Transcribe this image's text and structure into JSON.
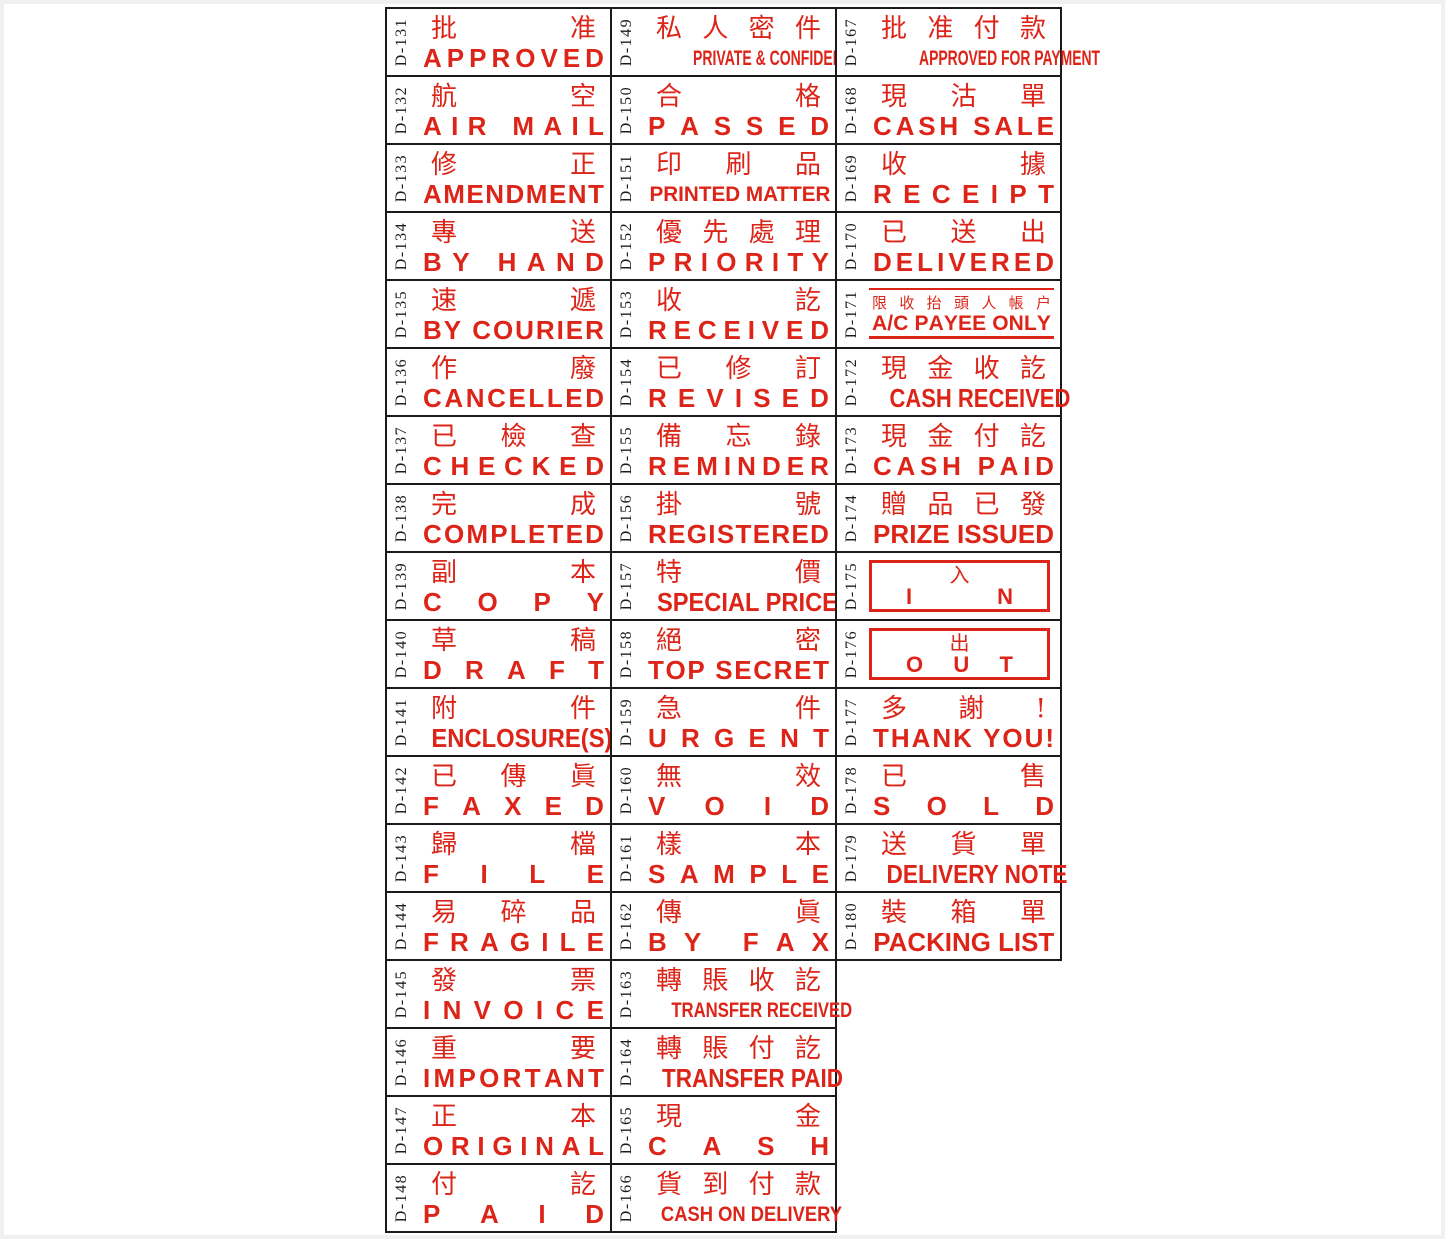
{
  "colors": {
    "stamp_red": "#dd2418",
    "grid_line": "#1a1a1a",
    "code_text": "#1c1c1c",
    "page_frame": "#f0f0f0",
    "paper": "#ffffff"
  },
  "catalog": {
    "columns": [
      {
        "stamps": [
          {
            "code": "D-131",
            "zh": "批准",
            "en": "APPROVED",
            "variant": "default"
          },
          {
            "code": "D-132",
            "zh": "航空",
            "en": "AIR MAIL",
            "variant": "default"
          },
          {
            "code": "D-133",
            "zh": "修正",
            "en": "AMENDMENT",
            "variant": "default"
          },
          {
            "code": "D-134",
            "zh": "專送",
            "en": "BY HAND",
            "variant": "default"
          },
          {
            "code": "D-135",
            "zh": "速遞",
            "en": "BY COURIER",
            "variant": "default"
          },
          {
            "code": "D-136",
            "zh": "作廢",
            "en": "CANCELLED",
            "variant": "default"
          },
          {
            "code": "D-137",
            "zh": "已檢查",
            "en": "CHECKED",
            "variant": "default"
          },
          {
            "code": "D-138",
            "zh": "完成",
            "en": "COMPLETED",
            "variant": "default"
          },
          {
            "code": "D-139",
            "zh": "副本",
            "en": "COPY",
            "variant": "default"
          },
          {
            "code": "D-140",
            "zh": "草稿",
            "en": "DRAFT",
            "variant": "default"
          },
          {
            "code": "D-141",
            "zh": "附件",
            "en": "ENCLOSURE(S)",
            "variant": "default"
          },
          {
            "code": "D-142",
            "zh": "已傳眞",
            "en": "FAXED",
            "variant": "default"
          },
          {
            "code": "D-143",
            "zh": "歸檔",
            "en": "FILE",
            "variant": "default"
          },
          {
            "code": "D-144",
            "zh": "易碎品",
            "en": "FRAGILE",
            "variant": "default"
          },
          {
            "code": "D-145",
            "zh": "發票",
            "en": "INVOICE",
            "variant": "default"
          },
          {
            "code": "D-146",
            "zh": "重要",
            "en": "IMPORTANT",
            "variant": "default"
          },
          {
            "code": "D-147",
            "zh": "正本",
            "en": "ORIGINAL",
            "variant": "default"
          },
          {
            "code": "D-148",
            "zh": "付訖",
            "en": "PAID",
            "variant": "default"
          }
        ]
      },
      {
        "stamps": [
          {
            "code": "D-149",
            "zh": "私人密件",
            "en": "PRIVATE & CONFIDENTIAL",
            "variant": "default"
          },
          {
            "code": "D-150",
            "zh": "合格",
            "en": "PASSED",
            "variant": "default"
          },
          {
            "code": "D-151",
            "zh": "印刷品",
            "en": "PRINTED MATTER",
            "variant": "default"
          },
          {
            "code": "D-152",
            "zh": "優先處理",
            "en": "PRIORITY",
            "variant": "default"
          },
          {
            "code": "D-153",
            "zh": "收訖",
            "en": "RECEIVED",
            "variant": "default"
          },
          {
            "code": "D-154",
            "zh": "已修訂",
            "en": "REVISED",
            "variant": "default"
          },
          {
            "code": "D-155",
            "zh": "備忘錄",
            "en": "REMINDER",
            "variant": "default"
          },
          {
            "code": "D-156",
            "zh": "掛號",
            "en": "REGISTERED",
            "variant": "default"
          },
          {
            "code": "D-157",
            "zh": "特價",
            "en": "SPECIAL PRICE",
            "variant": "default"
          },
          {
            "code": "D-158",
            "zh": "絕密",
            "en": "TOP SECRET",
            "variant": "default"
          },
          {
            "code": "D-159",
            "zh": "急件",
            "en": "URGENT",
            "variant": "default"
          },
          {
            "code": "D-160",
            "zh": "無效",
            "en": "VOID",
            "variant": "default"
          },
          {
            "code": "D-161",
            "zh": "樣本",
            "en": "SAMPLE",
            "variant": "default"
          },
          {
            "code": "D-162",
            "zh": "傳眞",
            "en": "BY FAX",
            "variant": "default"
          },
          {
            "code": "D-163",
            "zh": "轉賬收訖",
            "en": "TRANSFER RECEIVED",
            "variant": "default"
          },
          {
            "code": "D-164",
            "zh": "轉賬付訖",
            "en": "TRANSFER PAID",
            "variant": "default"
          },
          {
            "code": "D-165",
            "zh": "現金",
            "en": "CASH",
            "variant": "default"
          },
          {
            "code": "D-166",
            "zh": "貨到付款",
            "en": "CASH ON DELIVERY",
            "variant": "default"
          }
        ]
      },
      {
        "stamps": [
          {
            "code": "D-167",
            "zh": "批准付款",
            "en": "APPROVED FOR PAYMENT",
            "variant": "default"
          },
          {
            "code": "D-168",
            "zh": "現沽單",
            "en": "CASH SALE",
            "variant": "default"
          },
          {
            "code": "D-169",
            "zh": "收據",
            "en": "RECEIPT",
            "variant": "default"
          },
          {
            "code": "D-170",
            "zh": "已送出",
            "en": "DELIVERED",
            "variant": "default"
          },
          {
            "code": "D-171",
            "zh": "限收抬頭人帳户",
            "en": "A/C PAYEE ONLY",
            "variant": "ruled"
          },
          {
            "code": "D-172",
            "zh": "現金收訖",
            "en": "CASH RECEIVED",
            "variant": "default"
          },
          {
            "code": "D-173",
            "zh": "現金付訖",
            "en": "CASH PAID",
            "variant": "default"
          },
          {
            "code": "D-174",
            "zh": "贈品已發",
            "en": "PRIZE ISSUED",
            "variant": "default"
          },
          {
            "code": "D-175",
            "zh": "入",
            "en": "IN",
            "variant": "boxed"
          },
          {
            "code": "D-176",
            "zh": "出",
            "en": "OUT",
            "variant": "boxed"
          },
          {
            "code": "D-177",
            "zh": "多謝!",
            "en": "THANK YOU!",
            "variant": "default"
          },
          {
            "code": "D-178",
            "zh": "已售",
            "en": "SOLD",
            "variant": "default"
          },
          {
            "code": "D-179",
            "zh": "送貨單",
            "en": "DELIVERY NOTE",
            "variant": "default"
          },
          {
            "code": "D-180",
            "zh": "裝箱單",
            "en": "PACKING LIST",
            "variant": "default"
          }
        ]
      }
    ]
  }
}
